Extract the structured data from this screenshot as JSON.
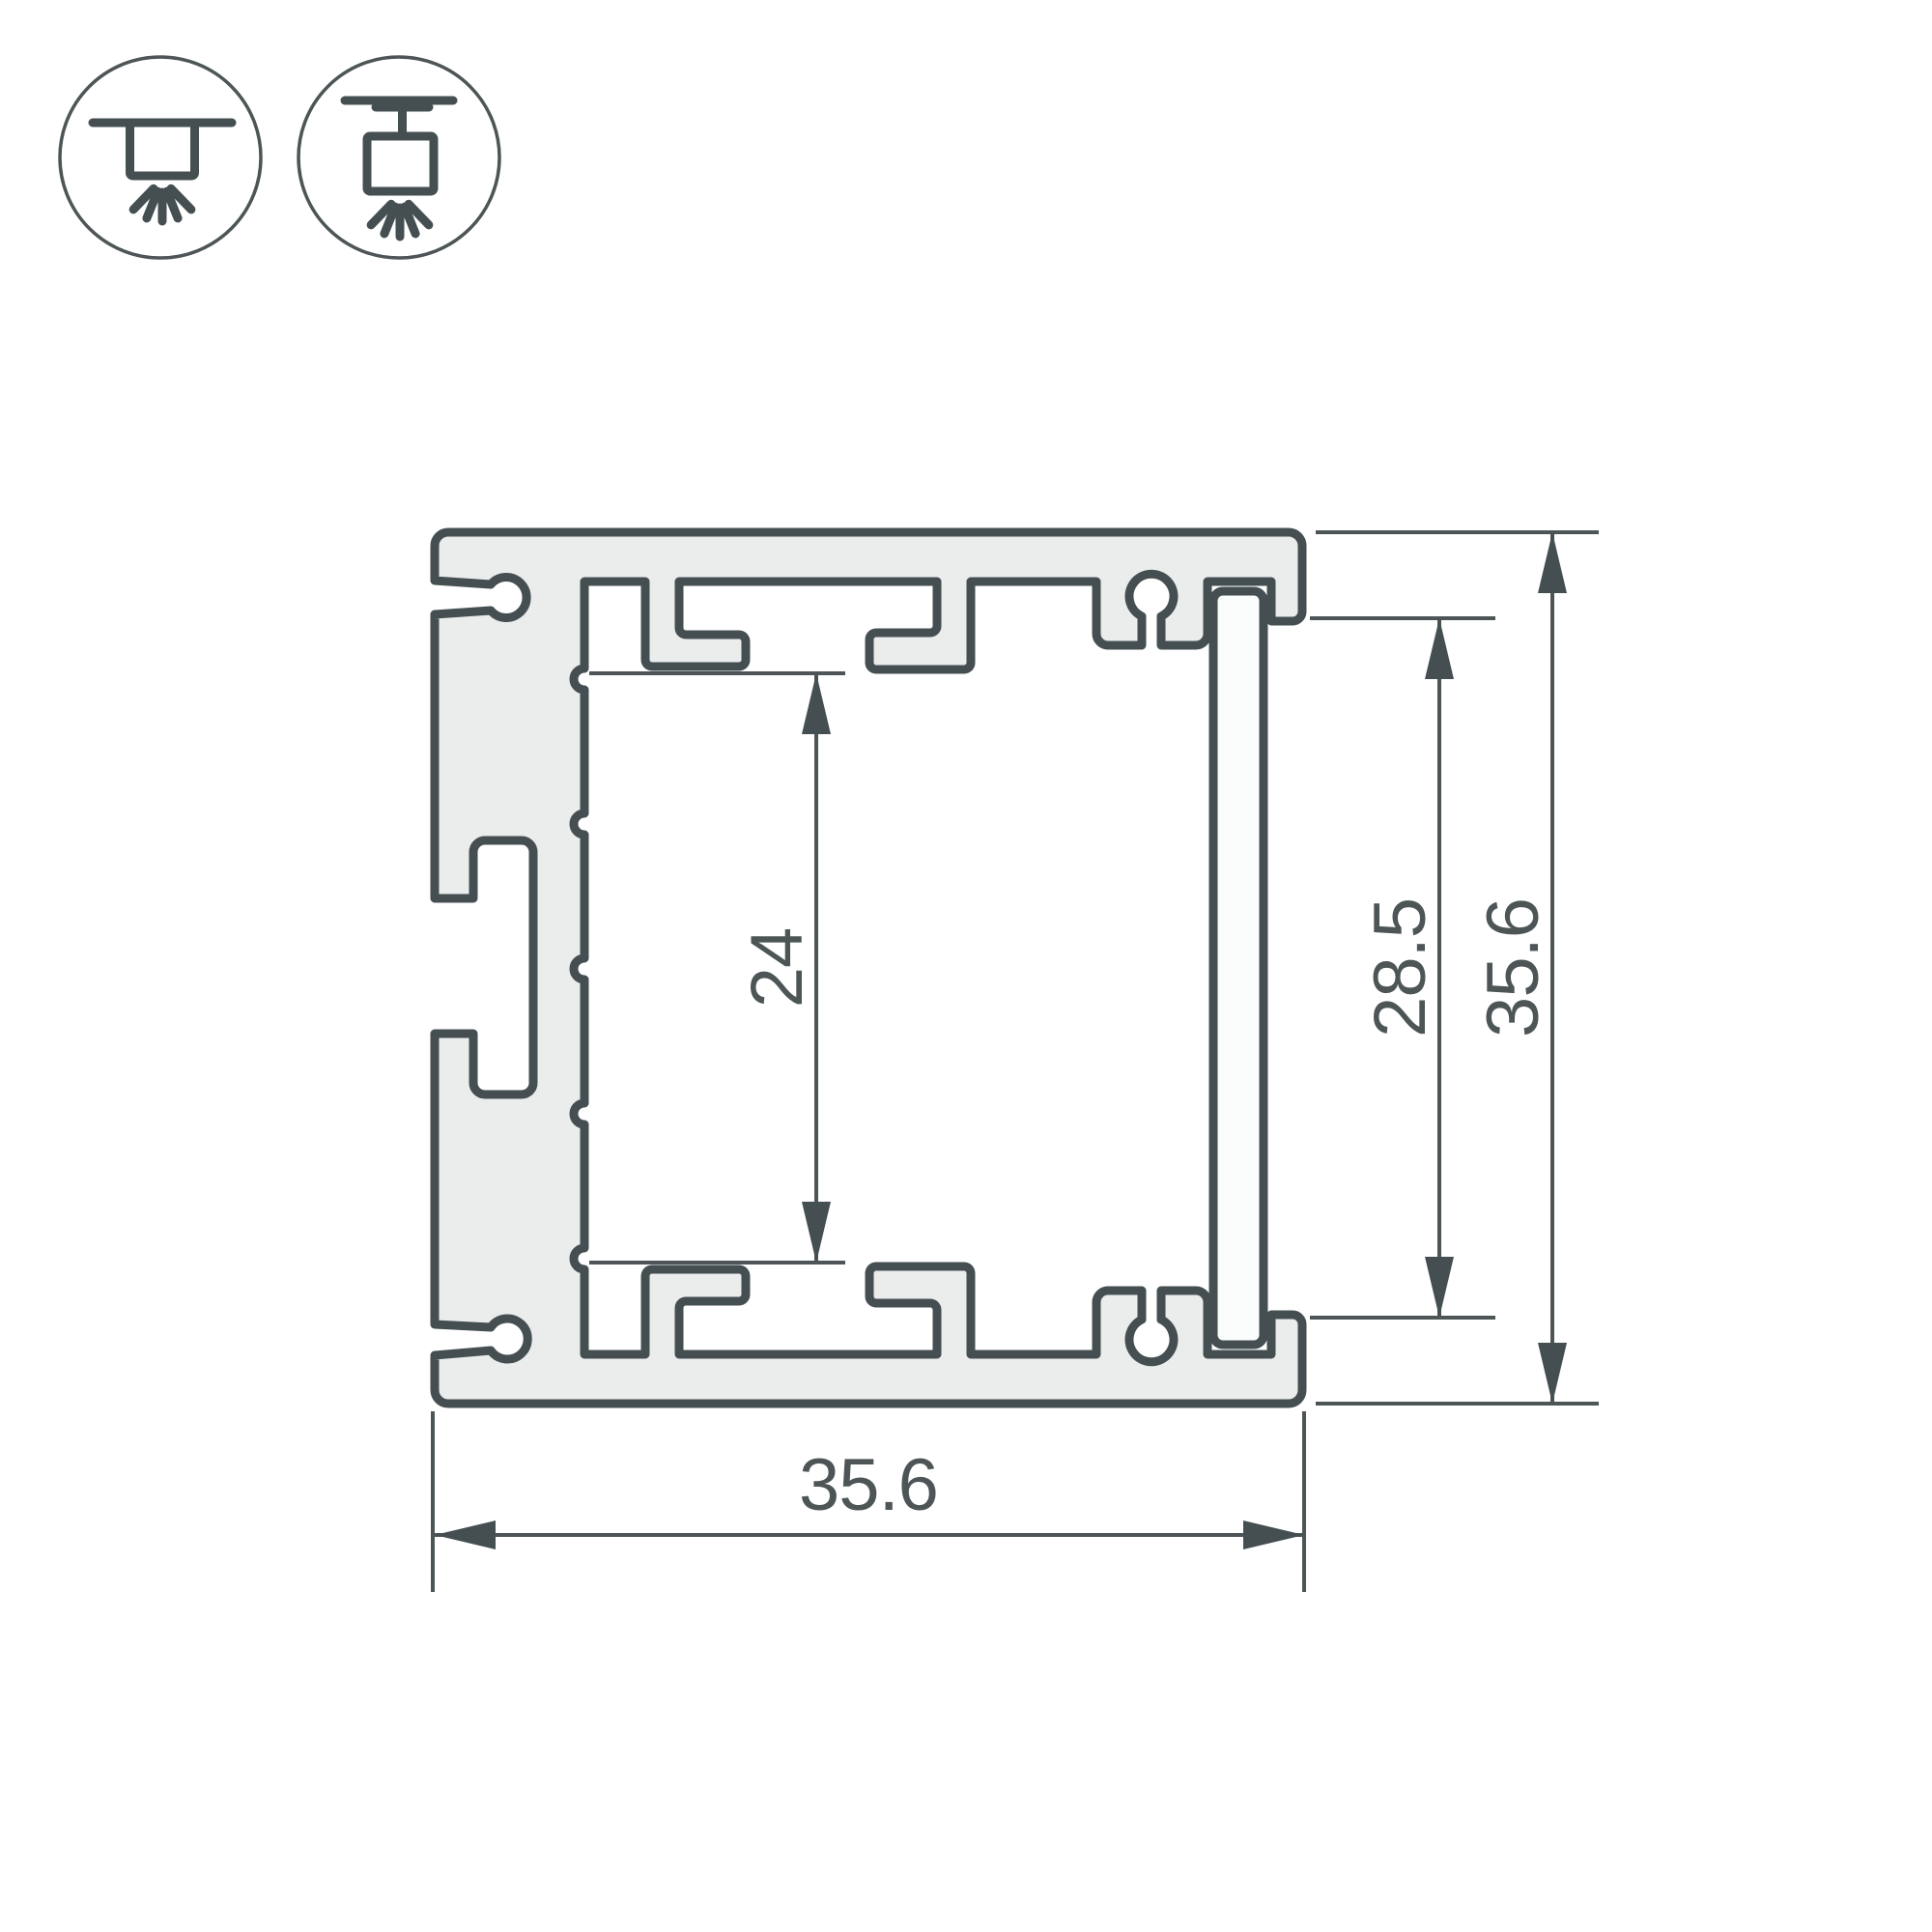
{
  "drawing": {
    "background": "#ffffff",
    "outline_color": "#454f52",
    "thin_line_color": "#4d5557",
    "material_fill": "#ebecec",
    "hatch_color": "#4b5456",
    "dimensions": {
      "cavity_height": "24",
      "window_height": "28.5",
      "overall_height": "35.6",
      "overall_width": "35.6"
    },
    "icons": [
      {
        "name": "surface-mount-icon"
      },
      {
        "name": "pendant-mount-icon"
      }
    ]
  }
}
